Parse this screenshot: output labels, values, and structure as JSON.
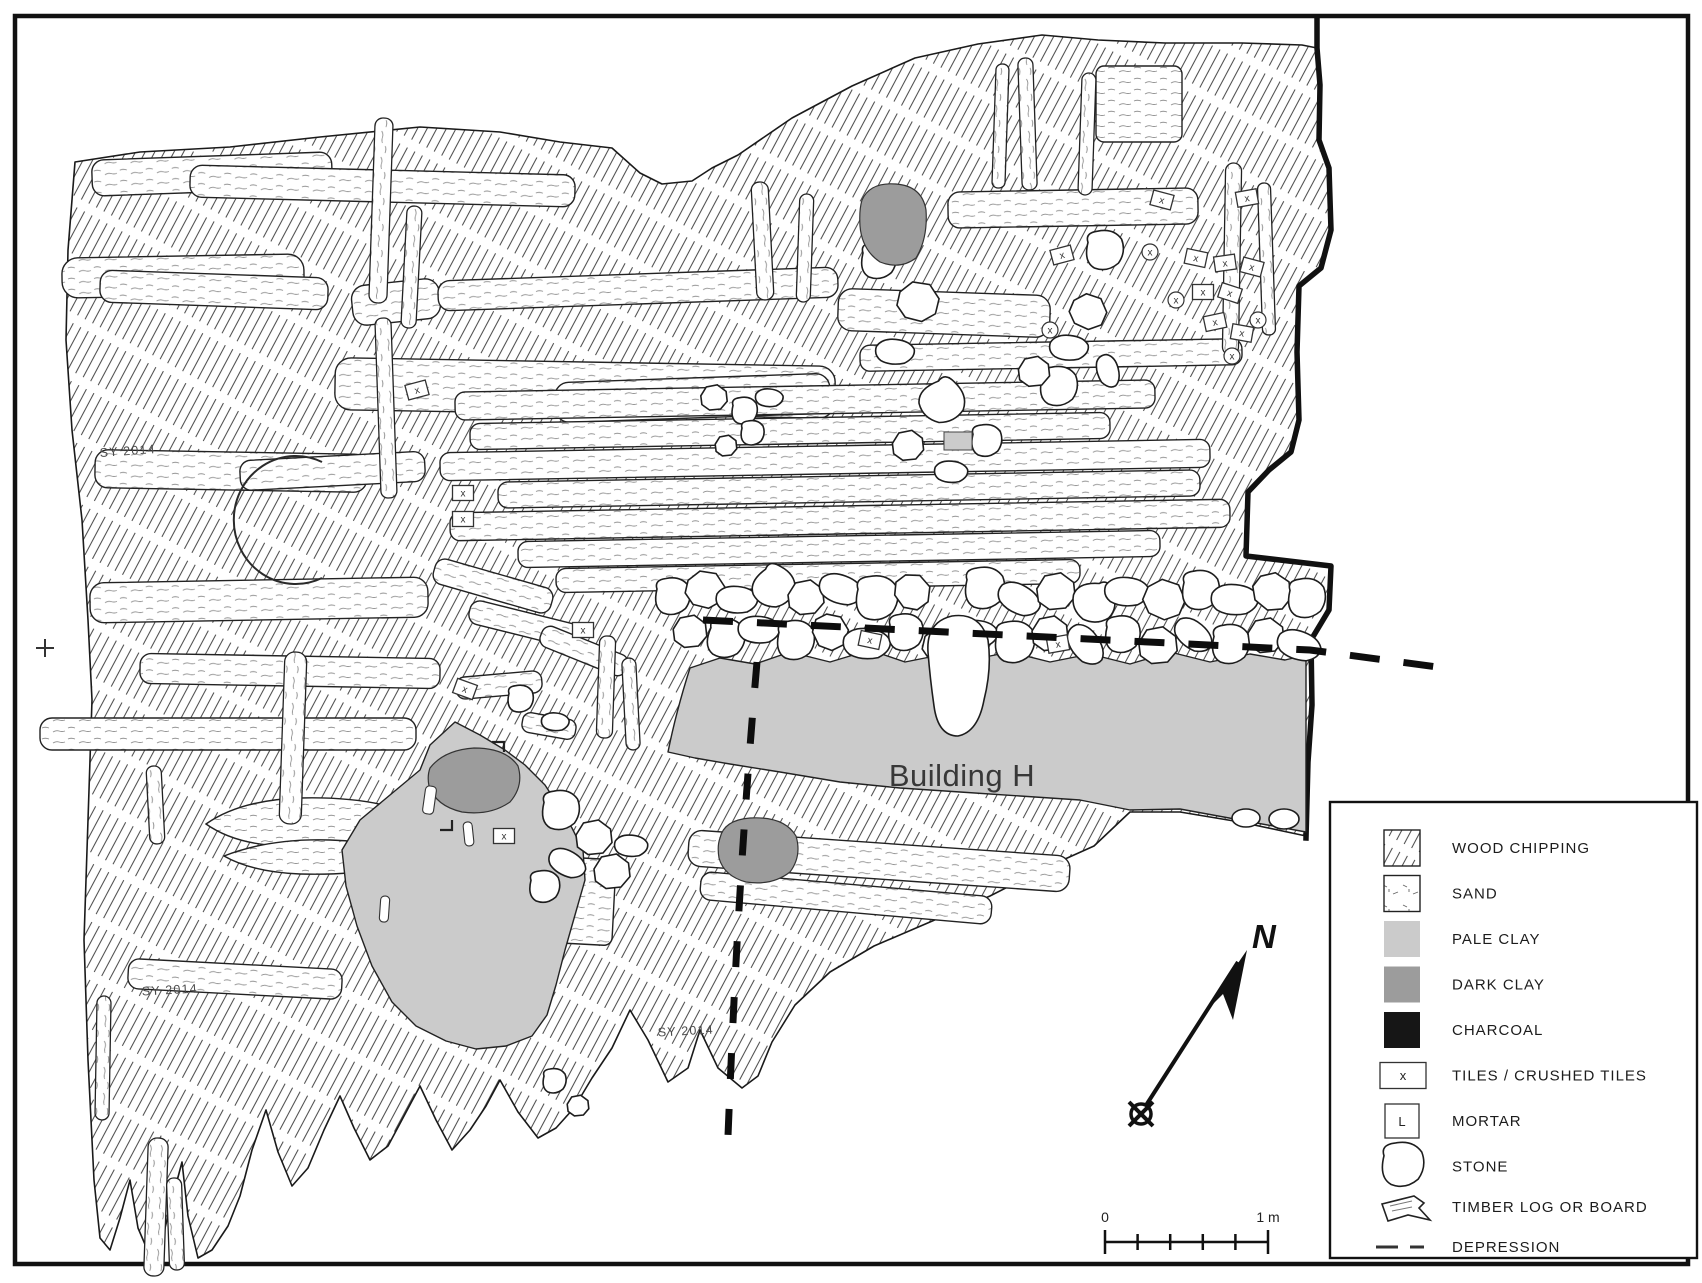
{
  "plan": {
    "labels": {
      "building": "Building H",
      "site_code": "SY 2014",
      "tile_marker": "x"
    }
  },
  "compass": {
    "label": "N"
  },
  "scale_bar": {
    "start": "0",
    "end": "1 m"
  },
  "legend": {
    "items": [
      {
        "label": "WOOD CHIPPING"
      },
      {
        "label": "SAND"
      },
      {
        "label": "PALE CLAY"
      },
      {
        "label": "DARK CLAY"
      },
      {
        "label": "CHARCOAL"
      },
      {
        "label": "TILES / CRUSHED TILES",
        "symbol": "x"
      },
      {
        "label": "MORTAR",
        "symbol": "L"
      },
      {
        "label": "STONE"
      },
      {
        "label": "TIMBER LOG OR BOARD"
      },
      {
        "label": "DEPRESSION"
      }
    ]
  },
  "colors": {
    "pale_clay": "#cbcbcb",
    "dark_clay": "#9c9c9c",
    "charcoal": "#161616",
    "line": "#1a1a1a"
  }
}
